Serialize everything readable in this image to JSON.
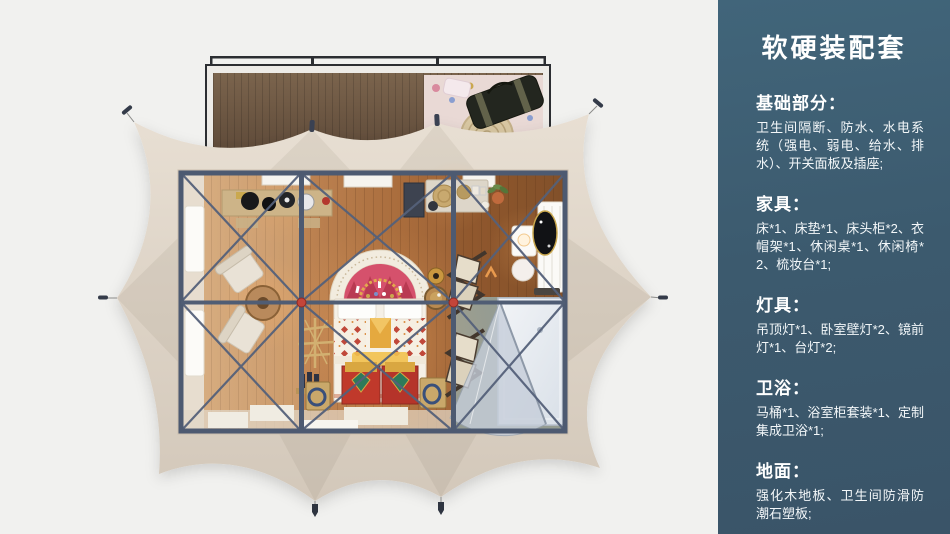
{
  "panel": {
    "title": "软硬装配套",
    "sections": [
      {
        "heading": "基础部分：",
        "body": "卫生间隔断、防水、水电系统（强电、弱电、给水、排水）、开关面板及插座;"
      },
      {
        "heading": "家具：",
        "body": "床*1、床垫*1、床头柜*2、衣帽架*1、休闲桌*1、休闲椅*2、梳妆台*1;"
      },
      {
        "heading": "灯具：",
        "body": "吊顶灯*1、卧室壁灯*2、镜前灯*1、台灯*2;"
      },
      {
        "heading": "卫浴：",
        "body": "马桶*1、浴室柜套装*1、定制集成卫浴*1;"
      },
      {
        "heading": "地面：",
        "body": "强化木地板、卫生间防滑防潮石塑板;"
      }
    ]
  },
  "colors": {
    "panel_bg": "#3c5a6e",
    "panel_text": "#ffffff",
    "page_bg": "#f1f1ef",
    "tent_canvas": "#ddd3c6",
    "steel_frame": "#4d5a71",
    "wood_floor": "#a96c3c",
    "deck_wood": "#6e5844",
    "accent_red": "#c0392b",
    "bathroom_floor": "#959c92"
  }
}
